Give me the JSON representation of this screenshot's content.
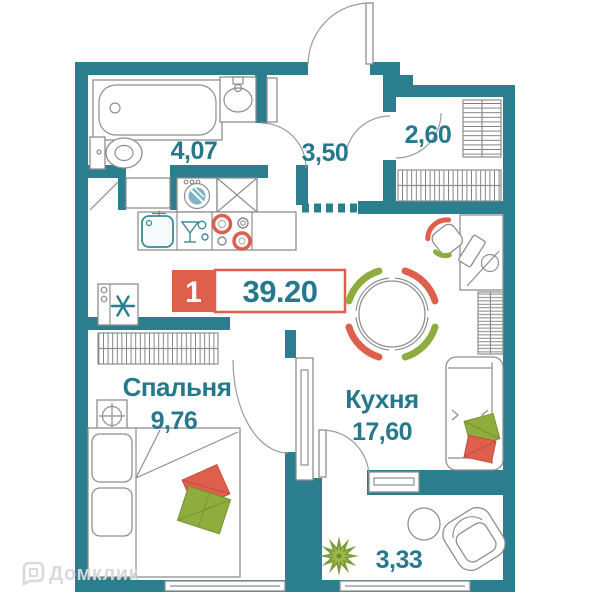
{
  "plan": {
    "badge": {
      "rooms_count": "1",
      "total_area": "39.20"
    },
    "rooms": {
      "bathroom": {
        "area": "4,07"
      },
      "hallway": {
        "area": "3,50"
      },
      "storage": {
        "area": "2,60"
      },
      "kitchen": {
        "name": "Кухня",
        "area": "17,60"
      },
      "bedroom": {
        "name": "Спальня",
        "area": "9,76"
      },
      "balcony": {
        "area": "3,33"
      }
    },
    "watermark": {
      "brand": "Домклик"
    },
    "colors": {
      "wall": "#2A7E8E",
      "label": "#26798C",
      "accent_red": "#DE5F4B",
      "accent_green": "#8EAD3E",
      "plant_green": "#7E9C35",
      "outline": "#8E8E8E",
      "watermark": "#D9D9D9"
    }
  }
}
